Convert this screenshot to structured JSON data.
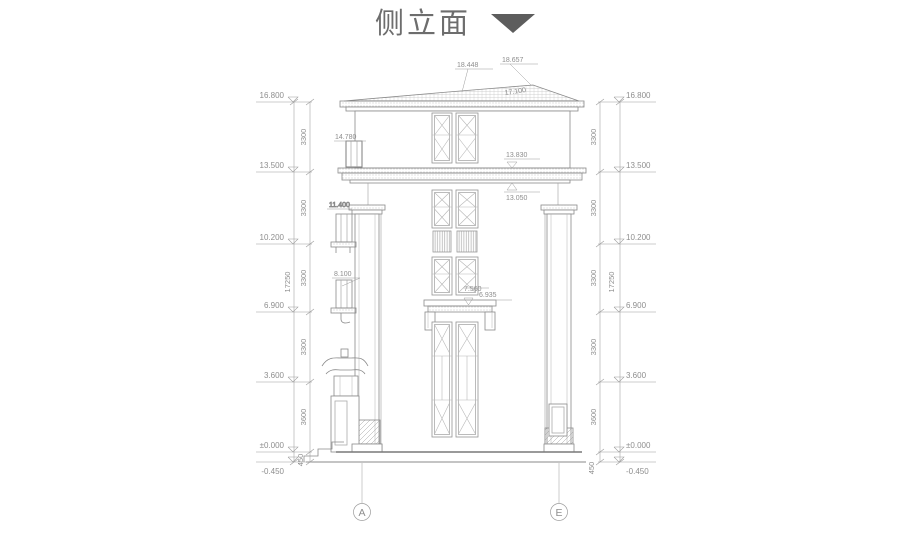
{
  "title": {
    "label": "侧立面"
  },
  "colors": {
    "title_text": "#6d6d6d",
    "marker": "#5d5d5d",
    "line": "#8a8a8a",
    "dim_text": "#8e8e8e"
  },
  "roof": {
    "dim_left": "18.448",
    "dim_right": "18.657",
    "slope_label": "17.100"
  },
  "labels": {
    "win4f": "14.780",
    "cornice_top": "13.830",
    "cornice_bottom": "13.050",
    "win3f": "11.400",
    "win2f": "8.100",
    "balcony_rail": "7.560",
    "balcony": "6.935"
  },
  "dims": {
    "elevations": [
      "16.800",
      "13.500",
      "10.200",
      "6.900",
      "3.600",
      "±0.000",
      "-0.450"
    ],
    "segments": [
      "3300",
      "3300",
      "3300",
      "3300",
      "3600"
    ],
    "base": "450",
    "overall": "17250"
  },
  "grid": {
    "left": "A",
    "right": "E"
  }
}
